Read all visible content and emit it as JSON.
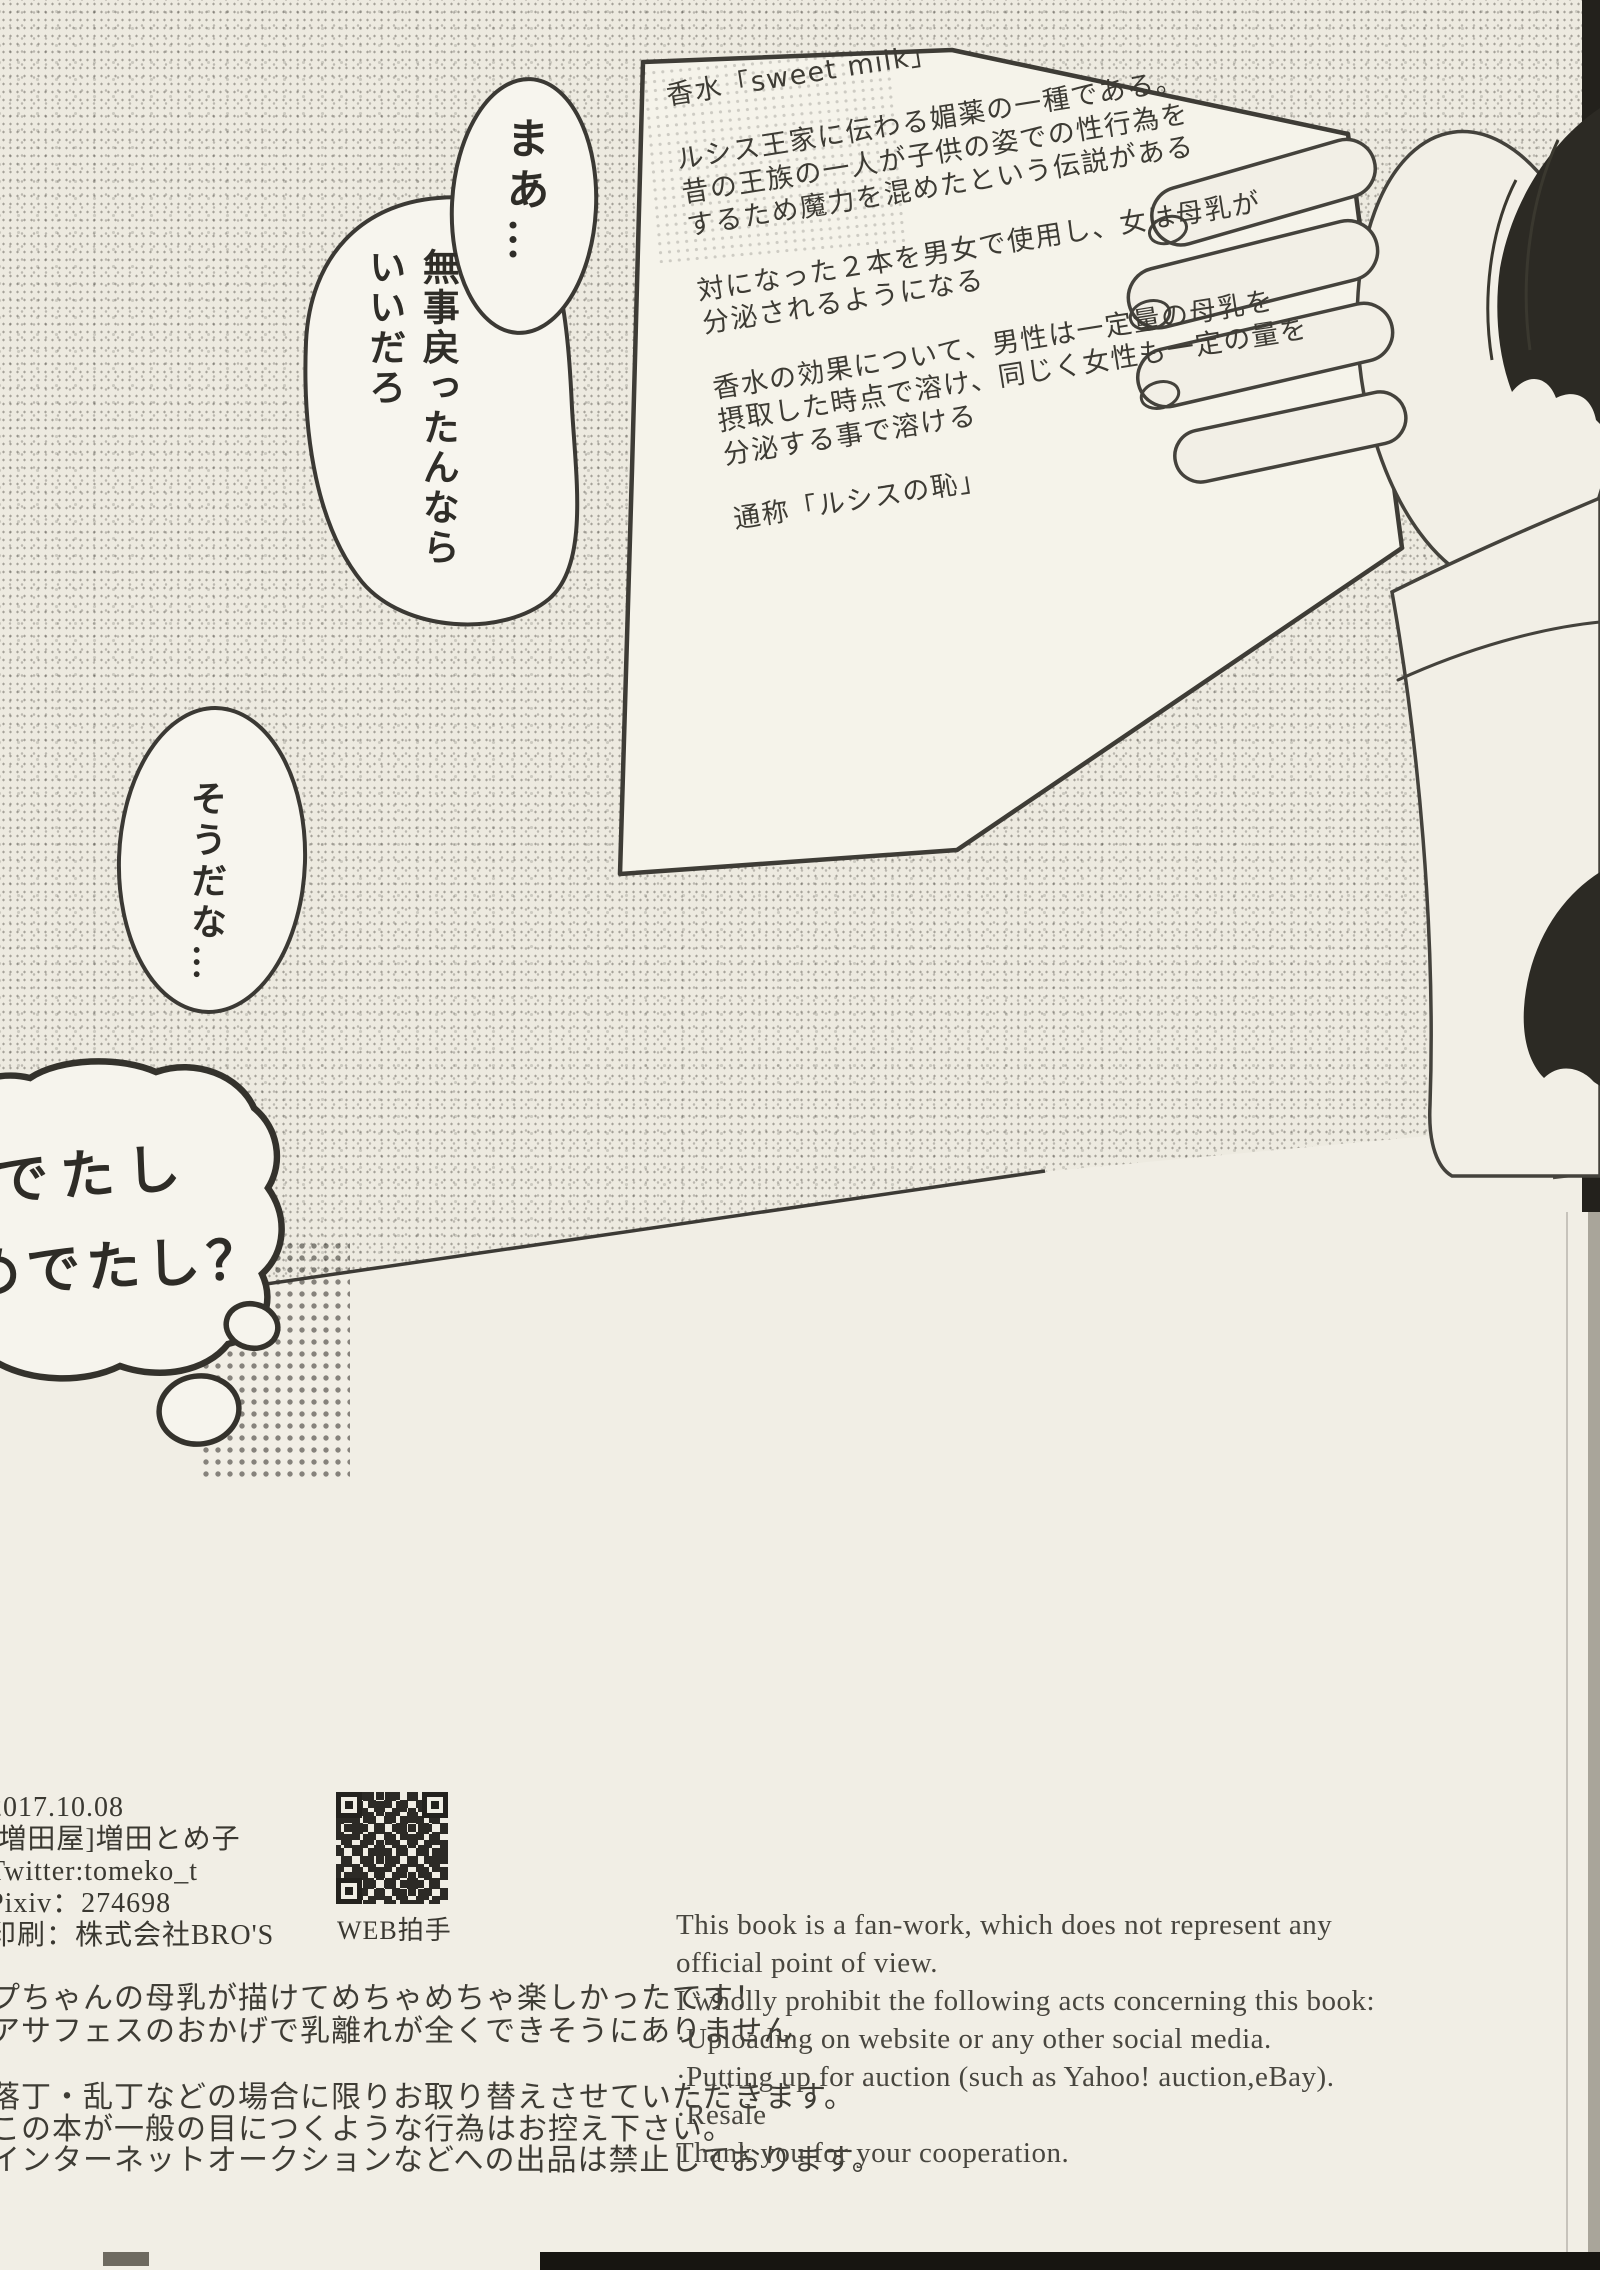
{
  "paper_note": {
    "title": "香水「sweet milk」",
    "para1": [
      "ルシス王家に伝わる媚薬の一種である。",
      "昔の王族の一人が子供の姿での性行為を",
      "するため魔力を混めたという伝説がある"
    ],
    "para2": [
      "対になった２本を男女で使用し、女は母乳が",
      "分泌されるようになる"
    ],
    "para3": [
      "香水の効果について、男性は一定量の母乳を",
      "摂取した時点で溶け、同じく女性も一定の量を",
      "分泌する事で溶ける"
    ],
    "alias": "通称「ルシスの恥」"
  },
  "bubbles": {
    "maa": "まあ…",
    "main": [
      "無事戻ったんなら",
      "いいだろ"
    ],
    "souda": "そうだな…",
    "thought": [
      "でたし",
      "めでたし？"
    ]
  },
  "credits": {
    "date": "2017.10.08",
    "circle": "[増田屋]増田とめ子",
    "twitter": "Twitter:tomeko_t",
    "pixiv": "Pixiv：274698",
    "printer": "印刷：株式会社BRO'S",
    "webclap": "WEB拍手"
  },
  "afterword": {
    "comment": [
      "プちゃんの母乳が描けてめちゃめちゃ楽しかったです！",
      "アサフェスのおかげで乳離れが全くできそうにありません"
    ],
    "notice": [
      "落丁・乱丁などの場合に限りお取り替えさせていただきます。",
      "この本が一般の目につくような行為はお控え下さい。",
      "インターネットオークションなどへの出品は禁止しております。"
    ]
  },
  "disclaimer_en": [
    "This book is a fan-work, which does not represent any",
    "official point of view.",
    "I wholly prohibit the following acts concerning this book:",
    "·Uploading on website or any other social media.",
    "·Putting up for auction (such as Yahoo! auction,eBay).",
    "·Resale",
    "Thank you for your cooperation."
  ],
  "colors": {
    "page_bg": "#f1eee5",
    "ink": "#34322c",
    "gutter_dark": "#23211c"
  }
}
